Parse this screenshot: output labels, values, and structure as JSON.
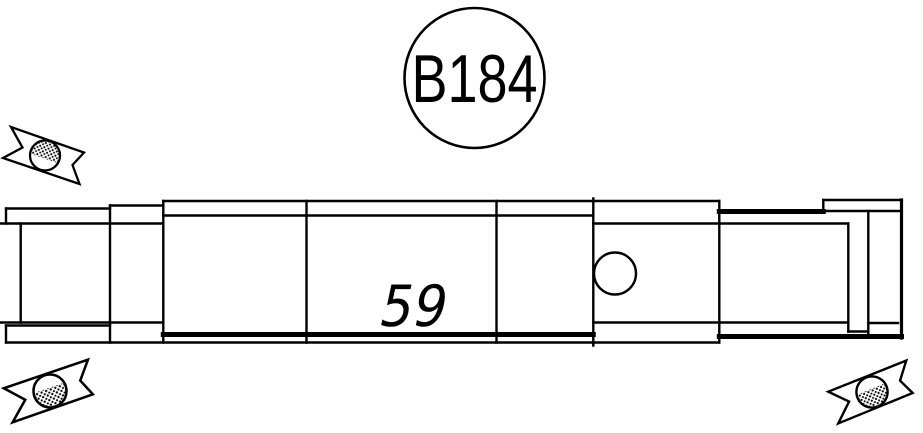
{
  "colors": {
    "line": "#000000",
    "background": "#ffffff"
  },
  "balloon": {
    "label": "B184"
  },
  "position_label": {
    "text": "59"
  },
  "icons": {
    "break_symbol_top_left": "break-cut-mark",
    "break_symbol_bottom_left": "break-cut-mark",
    "break_symbol_bottom_right": "break-cut-mark"
  }
}
